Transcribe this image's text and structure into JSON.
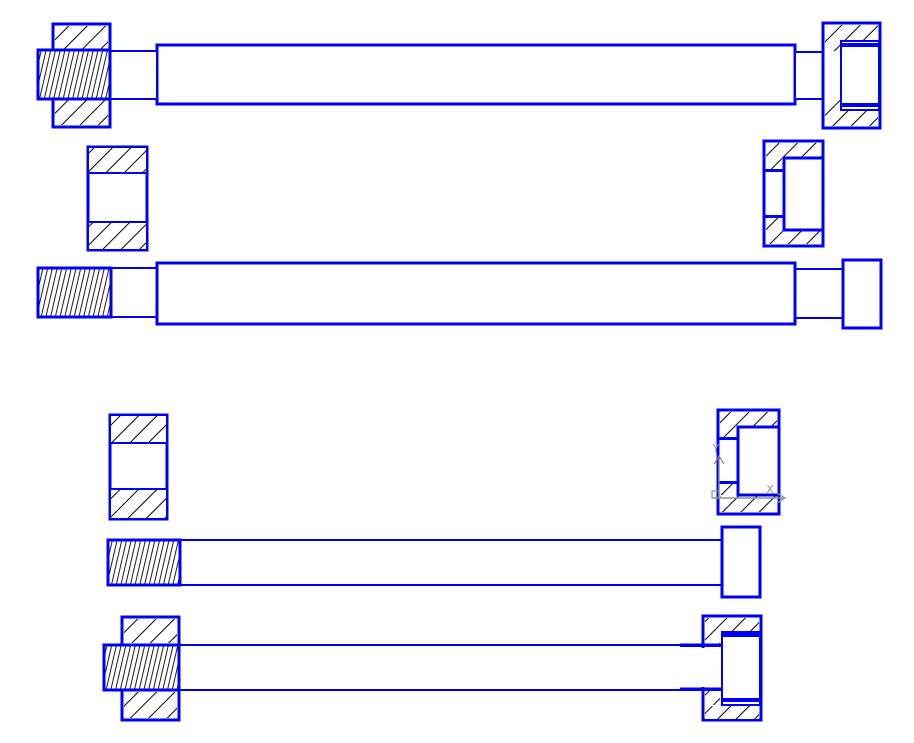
{
  "app": {
    "type": "cad-drawing-viewport",
    "background": "#ffffff"
  },
  "colors": {
    "entity": "#0000f5",
    "hatch_lines": "#000000",
    "ucs_icon": "#8f8f8f",
    "canvas_bg": "#ffffff"
  },
  "ucs_icon": {
    "x_label": "X",
    "y_label": "Y"
  },
  "drawing": {
    "description": "screw-shaft-bushing-and-cap-nut-section-views",
    "parts": [
      {
        "name": "top-shaft-body",
        "kind": "outline",
        "r": [
          157,
          45,
          638,
          59
        ],
        "sw": 3
      },
      {
        "name": "top-shaft-neck-left",
        "kind": "outline",
        "r": [
          110,
          51,
          47,
          48
        ],
        "sw": 2
      },
      {
        "name": "top-shaft-neck-right",
        "kind": "outline",
        "r": [
          795,
          52,
          28,
          47
        ],
        "sw": 2
      },
      {
        "name": "top-left-bushing-outline",
        "kind": "outline",
        "r": [
          53,
          24,
          57,
          103
        ],
        "sw": 3
      },
      {
        "name": "top-left-bushing-hatch-upper",
        "kind": "fill45",
        "r": [
          55,
          26,
          53,
          23
        ]
      },
      {
        "name": "top-left-bushing-hatch-lower",
        "kind": "fill45",
        "r": [
          55,
          100,
          53,
          25
        ]
      },
      {
        "name": "top-shaft-thread-left",
        "kind": "dense",
        "r": [
          38,
          50,
          72,
          49
        ],
        "sw": 3
      },
      {
        "name": "top-right-nut-outline",
        "kind": "outline",
        "r": [
          823,
          23,
          57,
          105
        ],
        "sw": 3
      },
      {
        "name": "top-right-nut-hatch-top",
        "kind": "fill45",
        "r": [
          825,
          25,
          53,
          15
        ]
      },
      {
        "name": "top-right-nut-hatch-bottom",
        "kind": "fill45",
        "r": [
          825,
          111,
          53,
          15
        ]
      },
      {
        "name": "top-right-nut-hatch-left-upper",
        "kind": "fill45",
        "r": [
          825,
          40,
          15,
          11
        ]
      },
      {
        "name": "top-right-nut-hatch-left-lower",
        "kind": "fill45",
        "r": [
          825,
          100,
          15,
          11
        ]
      },
      {
        "name": "top-right-nut-cavity",
        "kind": "white",
        "r": [
          841,
          41,
          38,
          69
        ],
        "sw": 2
      },
      {
        "name": "top-right-nut-thread-line-top",
        "kind": "blue",
        "r": [
          842,
          43,
          36,
          4
        ]
      },
      {
        "name": "top-right-nut-thread-line-bottom",
        "kind": "blue",
        "r": [
          842,
          103,
          36,
          4
        ]
      },
      {
        "name": "upper-sleeve-outline",
        "kind": "outline",
        "r": [
          88,
          147,
          59,
          103
        ],
        "sw": 3
      },
      {
        "name": "upper-sleeve-hatch-top",
        "kind": "hatch45",
        "r": [
          88,
          147,
          59,
          26
        ],
        "sw": 2
      },
      {
        "name": "upper-sleeve-hatch-bottom",
        "kind": "hatch45",
        "r": [
          88,
          222,
          59,
          28
        ],
        "sw": 2
      },
      {
        "name": "upper-cap-outline",
        "kind": "outline",
        "r": [
          764,
          141,
          59,
          105
        ],
        "sw": 3
      },
      {
        "name": "upper-cap-hatch-top",
        "kind": "fill45",
        "r": [
          766,
          143,
          55,
          15
        ]
      },
      {
        "name": "upper-cap-hatch-bottom",
        "kind": "fill45",
        "r": [
          766,
          230,
          55,
          14
        ]
      },
      {
        "name": "upper-cap-hatch-left-upper",
        "kind": "fill45",
        "r": [
          766,
          158,
          16,
          13
        ]
      },
      {
        "name": "upper-cap-hatch-left-lower",
        "kind": "fill45",
        "r": [
          766,
          217,
          16,
          13
        ]
      },
      {
        "name": "upper-cap-cavity",
        "kind": "white",
        "r": [
          784,
          158,
          39,
          72
        ],
        "sw": 3
      },
      {
        "name": "upper-cap-bore-line-top",
        "kind": "blue",
        "r": [
          764,
          169,
          20,
          3
        ]
      },
      {
        "name": "upper-cap-bore-line-bottom",
        "kind": "blue",
        "r": [
          764,
          215,
          20,
          3
        ]
      },
      {
        "name": "middle-shaft-neck-left",
        "kind": "outline",
        "r": [
          111,
          268,
          46,
          49
        ],
        "sw": 2
      },
      {
        "name": "middle-shaft-neck-right",
        "kind": "outline",
        "r": [
          795,
          269,
          48,
          49
        ],
        "sw": 2
      },
      {
        "name": "middle-shaft-body",
        "kind": "outline",
        "r": [
          157,
          263,
          638,
          61
        ],
        "sw": 3
      },
      {
        "name": "middle-shaft-thread-left",
        "kind": "dense",
        "r": [
          38,
          268,
          73,
          49
        ],
        "sw": 3
      },
      {
        "name": "middle-shaft-head-right",
        "kind": "outline",
        "r": [
          843,
          260,
          38,
          68
        ],
        "sw": 3
      },
      {
        "name": "lower-sleeve-outline",
        "kind": "outline",
        "r": [
          110,
          415,
          57,
          104
        ],
        "sw": 3
      },
      {
        "name": "lower-sleeve-hatch-top",
        "kind": "hatch45",
        "r": [
          110,
          415,
          57,
          28
        ],
        "sw": 2
      },
      {
        "name": "lower-sleeve-hatch-bottom",
        "kind": "hatch45",
        "r": [
          110,
          489,
          57,
          30
        ],
        "sw": 2
      },
      {
        "name": "lower-cap-outline",
        "kind": "outline",
        "r": [
          718,
          410,
          61,
          104
        ],
        "sw": 3
      },
      {
        "name": "lower-cap-hatch-top",
        "kind": "fill45",
        "r": [
          720,
          412,
          57,
          14
        ]
      },
      {
        "name": "lower-cap-hatch-bottom",
        "kind": "fill45",
        "r": [
          720,
          496,
          57,
          16
        ]
      },
      {
        "name": "lower-cap-hatch-left-upper",
        "kind": "fill45",
        "r": [
          720,
          426,
          16,
          13
        ]
      },
      {
        "name": "lower-cap-hatch-left-lower",
        "kind": "fill45",
        "r": [
          720,
          483,
          16,
          12
        ]
      },
      {
        "name": "lower-cap-cavity",
        "kind": "white",
        "r": [
          738,
          427,
          41,
          68
        ],
        "sw": 3
      },
      {
        "name": "lower-cap-bore-line-top",
        "kind": "blue",
        "r": [
          718,
          437,
          20,
          3
        ]
      },
      {
        "name": "lower-cap-bore-line-bottom",
        "kind": "blue",
        "r": [
          718,
          481,
          20,
          3
        ]
      },
      {
        "name": "bottom-screw-body",
        "kind": "outline",
        "r": [
          180,
          540,
          542,
          45
        ],
        "sw": 2
      },
      {
        "name": "bottom-screw-thread-left",
        "kind": "dense",
        "r": [
          108,
          540,
          72,
          45
        ],
        "sw": 3
      },
      {
        "name": "bottom-screw-head",
        "kind": "outline",
        "r": [
          722,
          527,
          38,
          70
        ],
        "sw": 3
      },
      {
        "name": "assembled-screw-body",
        "kind": "outline",
        "r": [
          179,
          645,
          524,
          45
        ],
        "sw": 2
      },
      {
        "name": "assembled-bushing-outline",
        "kind": "outline",
        "r": [
          122,
          617,
          57,
          103
        ],
        "sw": 3
      },
      {
        "name": "assembled-bushing-hatch-upper",
        "kind": "fill45",
        "r": [
          124,
          619,
          53,
          24
        ]
      },
      {
        "name": "assembled-bushing-hatch-lower",
        "kind": "fill45",
        "r": [
          124,
          692,
          53,
          26
        ]
      },
      {
        "name": "assembled-screw-thread-left",
        "kind": "dense",
        "r": [
          104,
          645,
          75,
          45
        ],
        "sw": 3
      },
      {
        "name": "assembled-cap-outline",
        "kind": "outline",
        "r": [
          703,
          616,
          58,
          104
        ],
        "sw": 3
      },
      {
        "name": "assembled-cap-bore-erase",
        "kind": "erase",
        "r": [
          700,
          648,
          22,
          39
        ]
      },
      {
        "name": "assembled-cap-hatch-top",
        "kind": "fill45",
        "r": [
          705,
          618,
          54,
          13
        ]
      },
      {
        "name": "assembled-cap-hatch-bottom",
        "kind": "fill45",
        "r": [
          705,
          706,
          54,
          13
        ]
      },
      {
        "name": "assembled-cap-hatch-left-upper",
        "kind": "fill45",
        "r": [
          705,
          631,
          15,
          15
        ]
      },
      {
        "name": "assembled-cap-hatch-left-lower",
        "kind": "fill45",
        "r": [
          705,
          690,
          15,
          15
        ]
      },
      {
        "name": "assembled-cap-cavity",
        "kind": "white",
        "r": [
          722,
          632,
          38,
          73
        ],
        "sw": 2
      },
      {
        "name": "assembled-cap-thread-line-top",
        "kind": "blue",
        "r": [
          723,
          633,
          36,
          4
        ]
      },
      {
        "name": "assembled-cap-thread-line-bottom",
        "kind": "blue",
        "r": [
          723,
          698,
          36,
          4
        ]
      },
      {
        "name": "assembled-screw-engage-line-top",
        "kind": "blue",
        "r": [
          680,
          643.5,
          42,
          3.5
        ]
      },
      {
        "name": "assembled-screw-engage-line-bottom",
        "kind": "blue",
        "r": [
          680,
          687.5,
          42,
          3.5
        ]
      }
    ]
  }
}
